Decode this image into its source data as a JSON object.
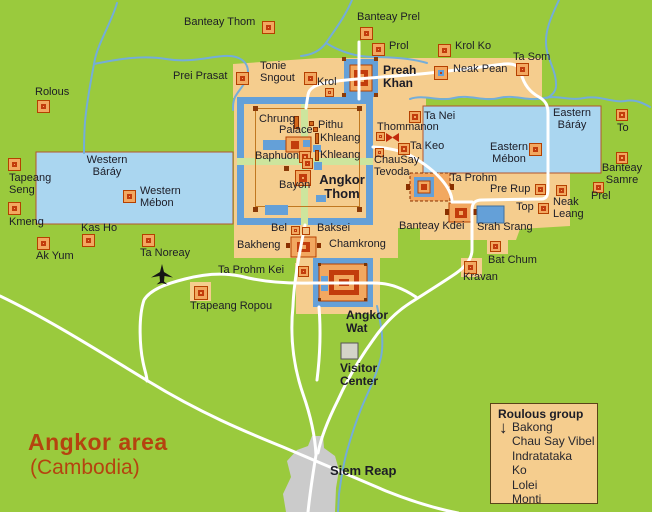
{
  "map": {
    "region_title": "Angkor area",
    "region_subtitle": "(Cambodia)"
  },
  "legend": {
    "title": "Roulous group",
    "arrow_icon": "↓",
    "items": [
      "Bakong",
      "Chau Say Vibel",
      "Indratataka",
      "Ko",
      "Lolei",
      "Monti"
    ]
  },
  "colors": {
    "land_green": "#9aca3d",
    "central_zone_tan": "#f5cd8e",
    "baray_water": "#aad6f0",
    "moat_water": "#64a0d8",
    "river": "#74add9",
    "road": "#ffffff",
    "inner_road_pale": "#cde59d",
    "marker_fill": "#f2a860",
    "marker_border": "#b54000",
    "marker_core_red": "#c23c0c",
    "town_gray": "#cbcbcb",
    "title_red": "#b5430f",
    "label_text": "#1c1c26"
  },
  "labels": [
    {
      "t": "Banteay Thom",
      "x": 184,
      "y": 16
    },
    {
      "t": "Banteay Prel",
      "x": 357,
      "y": 11
    },
    {
      "t": "Prol",
      "x": 389,
      "y": 40
    },
    {
      "t": "Krol Ko",
      "x": 455,
      "y": 40
    },
    {
      "t": "Ta Som",
      "x": 513,
      "y": 51
    },
    {
      "t": "Neak Pean",
      "x": 453,
      "y": 63
    },
    {
      "t": "Prei Prasat",
      "x": 173,
      "y": 70
    },
    {
      "t": "Tonie\nSngout",
      "x": 260,
      "y": 60
    },
    {
      "t": "Krol",
      "x": 317,
      "y": 76
    },
    {
      "t": "Preah\nKhan",
      "x": 383,
      "y": 64,
      "b": 1,
      "s": 12
    },
    {
      "t": "Rolous",
      "x": 35,
      "y": 86
    },
    {
      "t": "Western\nBáráy",
      "x": 107,
      "y": 154,
      "c": 1
    },
    {
      "t": "Western\nMébon",
      "x": 140,
      "y": 185
    },
    {
      "t": "Tapeang\nSeng",
      "x": 9,
      "y": 172
    },
    {
      "t": "Kmeng",
      "x": 9,
      "y": 216
    },
    {
      "t": "Kas Ho",
      "x": 81,
      "y": 222
    },
    {
      "t": "Ak Yum",
      "x": 36,
      "y": 250
    },
    {
      "t": "Ta Noreay",
      "x": 140,
      "y": 247
    },
    {
      "t": "Ta Prohm Kei",
      "x": 218,
      "y": 264
    },
    {
      "t": "Trapeang Ropou",
      "x": 190,
      "y": 300
    },
    {
      "t": "Chrung",
      "x": 259,
      "y": 113
    },
    {
      "t": "Palace",
      "x": 279,
      "y": 124
    },
    {
      "t": "Pithu",
      "x": 318,
      "y": 119
    },
    {
      "t": "Khleang",
      "x": 320,
      "y": 132
    },
    {
      "t": "Khleang",
      "x": 320,
      "y": 149
    },
    {
      "t": "Baphuon",
      "x": 255,
      "y": 150
    },
    {
      "t": "Bayon",
      "x": 279,
      "y": 179
    },
    {
      "t": "Angkor\nThom",
      "x": 342,
      "y": 173,
      "b": 1,
      "c": 1,
      "s": 13
    },
    {
      "t": "Thommanon",
      "x": 377,
      "y": 121
    },
    {
      "t": "Ta Nei",
      "x": 424,
      "y": 110
    },
    {
      "t": "Ta Keo",
      "x": 410,
      "y": 140
    },
    {
      "t": "ChauSay\nTevoda",
      "x": 374,
      "y": 154
    },
    {
      "t": "Eastern\nBáráy",
      "x": 572,
      "y": 107,
      "c": 1
    },
    {
      "t": "Eastern\nMébon",
      "x": 509,
      "y": 141,
      "c": 1
    },
    {
      "t": "To",
      "x": 617,
      "y": 122
    },
    {
      "t": "Banteay\nSamre",
      "x": 622,
      "y": 162,
      "c": 1
    },
    {
      "t": "Prel",
      "x": 591,
      "y": 190
    },
    {
      "t": "Neak\nLeang",
      "x": 553,
      "y": 196
    },
    {
      "t": "Pre Rup",
      "x": 490,
      "y": 183
    },
    {
      "t": "Top",
      "x": 516,
      "y": 201
    },
    {
      "t": "Srah Srang",
      "x": 477,
      "y": 221
    },
    {
      "t": "Banteay Kdei",
      "x": 399,
      "y": 220
    },
    {
      "t": "Bat Chum",
      "x": 488,
      "y": 254
    },
    {
      "t": "Kravan",
      "x": 463,
      "y": 271
    },
    {
      "t": "Bel",
      "x": 271,
      "y": 222
    },
    {
      "t": "Baksei",
      "x": 317,
      "y": 222
    },
    {
      "t": "Chamkrong",
      "x": 329,
      "y": 238
    },
    {
      "t": "Bakheng",
      "x": 237,
      "y": 239
    },
    {
      "t": "Ta Prohm",
      "x": 450,
      "y": 172
    },
    {
      "t": "Angkor\nWat",
      "x": 346,
      "y": 309,
      "b": 1,
      "s": 12
    },
    {
      "t": "Visitor\nCenter",
      "x": 340,
      "y": 362,
      "b": 1,
      "s": 12
    },
    {
      "t": "Siem Reap",
      "x": 330,
      "y": 464,
      "b": 1,
      "s": 13
    }
  ],
  "markers": [
    {
      "n": "banteay-thom",
      "t": "std",
      "x": 262,
      "y": 21,
      "s": 13
    },
    {
      "n": "banteay-prel",
      "t": "std",
      "x": 360,
      "y": 27,
      "s": 13
    },
    {
      "n": "prol",
      "t": "std",
      "x": 372,
      "y": 43,
      "s": 13
    },
    {
      "n": "krol-ko",
      "t": "std",
      "x": 438,
      "y": 44,
      "s": 13
    },
    {
      "n": "ta-som",
      "t": "std",
      "x": 516,
      "y": 63,
      "s": 13
    },
    {
      "n": "prei-prasat",
      "t": "std",
      "x": 236,
      "y": 72,
      "s": 13
    },
    {
      "n": "tonie-sngout",
      "t": "std",
      "x": 304,
      "y": 72,
      "s": 13
    },
    {
      "n": "rolous",
      "t": "std",
      "x": 37,
      "y": 100,
      "s": 13
    },
    {
      "n": "tapeang-seng",
      "t": "std",
      "x": 8,
      "y": 158,
      "s": 13
    },
    {
      "n": "kmeng",
      "t": "std",
      "x": 8,
      "y": 202,
      "s": 13
    },
    {
      "n": "kas-ho",
      "t": "std",
      "x": 82,
      "y": 234,
      "s": 13
    },
    {
      "n": "ak-yum",
      "t": "std",
      "x": 37,
      "y": 237,
      "s": 13
    },
    {
      "n": "ta-noreay",
      "t": "std",
      "x": 142,
      "y": 234,
      "s": 13
    },
    {
      "n": "western-mebon",
      "t": "std",
      "x": 123,
      "y": 190,
      "s": 13
    },
    {
      "n": "to",
      "t": "std",
      "x": 616,
      "y": 109,
      "s": 12
    },
    {
      "n": "banteay-samre",
      "t": "std",
      "x": 616,
      "y": 152,
      "s": 12
    },
    {
      "n": "prel",
      "t": "std",
      "x": 593,
      "y": 182,
      "s": 11
    },
    {
      "n": "kravan",
      "t": "std",
      "x": 464,
      "y": 261,
      "s": 13
    },
    {
      "n": "eastern-mebon",
      "t": "std",
      "x": 529,
      "y": 143,
      "s": 13
    },
    {
      "n": "ta-nei",
      "t": "std",
      "x": 409,
      "y": 111,
      "s": 12
    },
    {
      "n": "ta-keo",
      "t": "std",
      "x": 398,
      "y": 143,
      "s": 12
    },
    {
      "n": "baphuon",
      "t": "std",
      "x": 299,
      "y": 151,
      "s": 12
    },
    {
      "n": "pre-rup",
      "t": "std",
      "x": 535,
      "y": 184,
      "s": 11
    },
    {
      "n": "neak-leang",
      "t": "std",
      "x": 556,
      "y": 185,
      "s": 11
    },
    {
      "n": "top",
      "t": "std",
      "x": 538,
      "y": 203,
      "s": 11
    },
    {
      "n": "bat-chum",
      "t": "std",
      "x": 490,
      "y": 241,
      "s": 11
    },
    {
      "n": "ta-prohm-kei",
      "t": "std",
      "x": 298,
      "y": 266,
      "s": 11
    },
    {
      "n": "bayon-center",
      "t": "std",
      "x": 302,
      "y": 158,
      "s": 11
    },
    {
      "n": "trapeang-ropou",
      "t": "std",
      "x": 194,
      "y": 286,
      "s": 14
    },
    {
      "n": "krol",
      "t": "mini",
      "x": 325,
      "y": 88,
      "s": 9
    },
    {
      "n": "thommanon",
      "t": "mini",
      "x": 376,
      "y": 132,
      "s": 9
    },
    {
      "n": "chausay-tevoda",
      "t": "mini",
      "x": 375,
      "y": 148,
      "s": 9
    },
    {
      "n": "bel",
      "t": "mini",
      "x": 291,
      "y": 226,
      "s": 9
    },
    {
      "n": "bel-east",
      "t": "open",
      "x": 302,
      "y": 227,
      "s": 8
    },
    {
      "n": "neak-pean",
      "t": "neak",
      "x": 434,
      "y": 66,
      "s": 14
    },
    {
      "n": "bayon",
      "t": "bayon",
      "x": 295,
      "y": 170,
      "s": 16
    },
    {
      "n": "chrung-bar",
      "t": "bar",
      "x": 294,
      "y": 116,
      "w": 5,
      "h": 13
    },
    {
      "n": "khleang-north-bar",
      "t": "bar",
      "x": 315,
      "y": 133,
      "w": 4,
      "h": 11
    },
    {
      "n": "khleang-south-bar",
      "t": "bar",
      "x": 315,
      "y": 150,
      "w": 4,
      "h": 11
    },
    {
      "n": "pithu-a",
      "t": "bar",
      "x": 309,
      "y": 121,
      "w": 5,
      "h": 5
    },
    {
      "n": "pithu-b",
      "t": "bar",
      "x": 313,
      "y": 127,
      "w": 5,
      "h": 5
    },
    {
      "n": "angkor-thom-wall-nw",
      "t": "dot",
      "x": 253,
      "y": 106,
      "w": 5,
      "h": 5
    },
    {
      "n": "angkor-thom-wall-ne",
      "t": "dot",
      "x": 357,
      "y": 106,
      "w": 5,
      "h": 5
    },
    {
      "n": "angkor-thom-wall-sw",
      "t": "dot",
      "x": 253,
      "y": 207,
      "w": 5,
      "h": 5
    },
    {
      "n": "angkor-thom-wall-se",
      "t": "dot",
      "x": 357,
      "y": 207,
      "w": 5,
      "h": 5
    },
    {
      "n": "baphuon-west-dot",
      "t": "dot",
      "x": 284,
      "y": 166,
      "w": 5,
      "h": 5
    }
  ]
}
